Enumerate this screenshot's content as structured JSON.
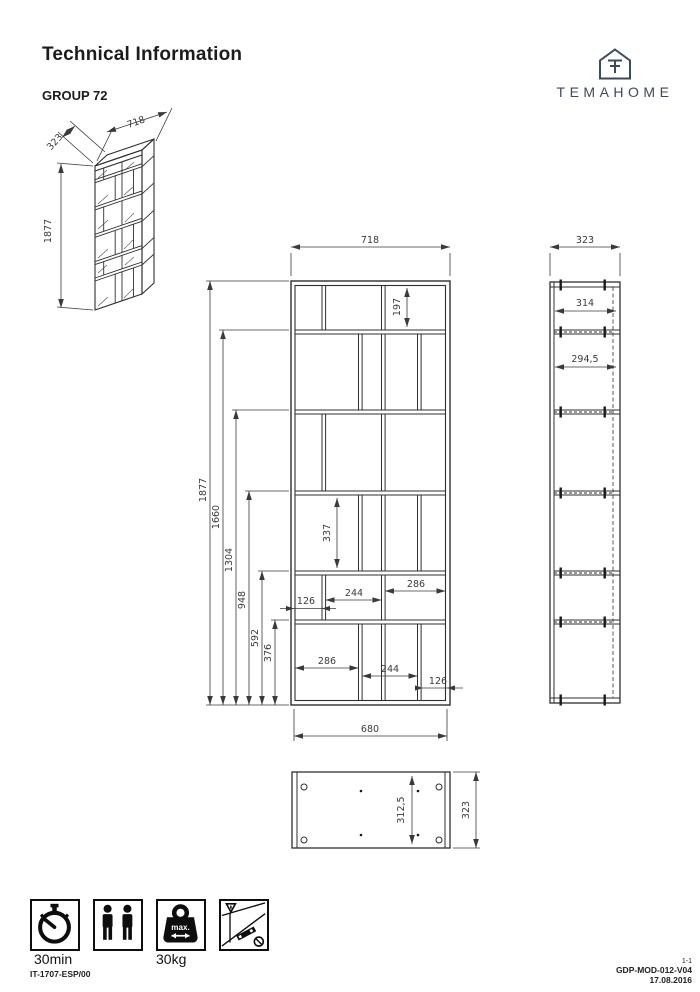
{
  "header": {
    "title": "Technical Information",
    "group": "GROUP 72",
    "brand": "TEMAHOME"
  },
  "iso_view": {
    "depth": "323",
    "width": "718",
    "height": "1877"
  },
  "front_view": {
    "top_width": "718",
    "bottom_width": "680",
    "stack_heights": [
      "1877",
      "1660",
      "1304",
      "948",
      "592",
      "376"
    ],
    "row1_height": "197",
    "row4_height": "337",
    "row5_widths": [
      "126",
      "244",
      "286"
    ],
    "row6_widths": [
      "286",
      "244",
      "126"
    ]
  },
  "side_view": {
    "top_width": "323",
    "inner_top": "314",
    "inner_second": "294,5"
  },
  "bottom_view": {
    "inner_depth": "312,5",
    "outer_depth": "323"
  },
  "icons": {
    "time_label": "30min",
    "weight_label": "30kg",
    "weight_inner": "max."
  },
  "footer": {
    "doc_left": "IT-1707-ESP/00",
    "page": "1-1",
    "code": "GDP-MOD-012-V04",
    "date": "17.08.2016"
  }
}
